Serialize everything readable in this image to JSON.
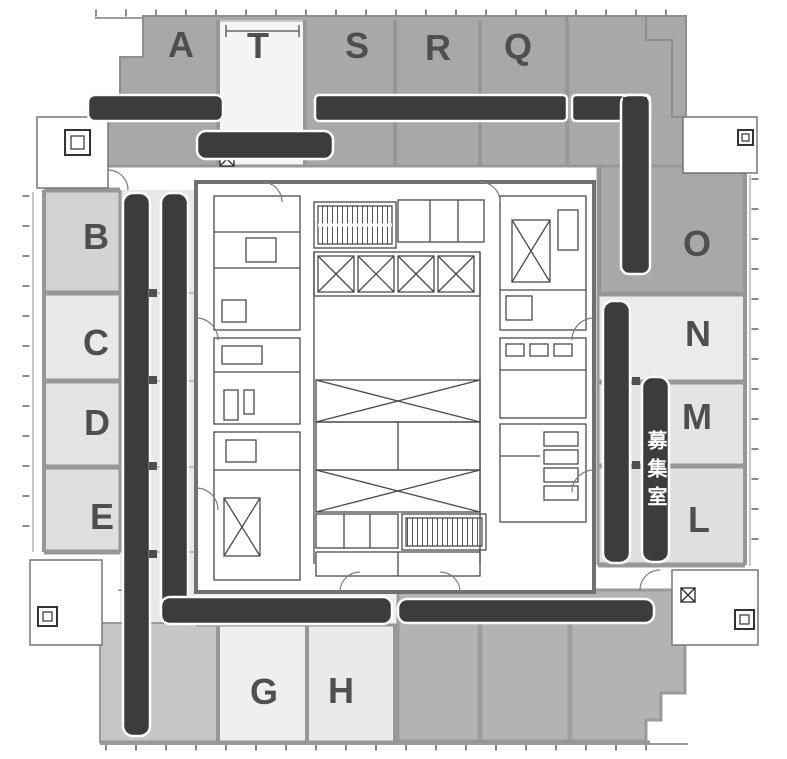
{
  "floorplan": {
    "type": "office-building-floor-plan",
    "vacancy": {
      "label": "募集室",
      "text_color": "#ffffff",
      "bar_color": "#3c3c3c"
    },
    "rooms": {
      "top": [
        {
          "label": "A"
        },
        {
          "label": "T"
        },
        {
          "label": "S"
        },
        {
          "label": "R"
        },
        {
          "label": "Q"
        }
      ],
      "left": [
        {
          "label": "B"
        },
        {
          "label": "C"
        },
        {
          "label": "D"
        },
        {
          "label": "E"
        }
      ],
      "right": [
        {
          "label": "O"
        },
        {
          "label": "N"
        },
        {
          "label": "M"
        },
        {
          "label": "L"
        }
      ],
      "bottom": [
        {
          "label": "G"
        },
        {
          "label": "H"
        }
      ]
    },
    "colors": {
      "room_dark_gray": "#a8a8a8",
      "room_light_gray": "#e9e9e9",
      "bottom_right_gray": "#b3b3b3",
      "highlight_bar": "#3c3c3c",
      "wall": "#8a8a8a",
      "label_text": "#4f4f4f"
    }
  }
}
